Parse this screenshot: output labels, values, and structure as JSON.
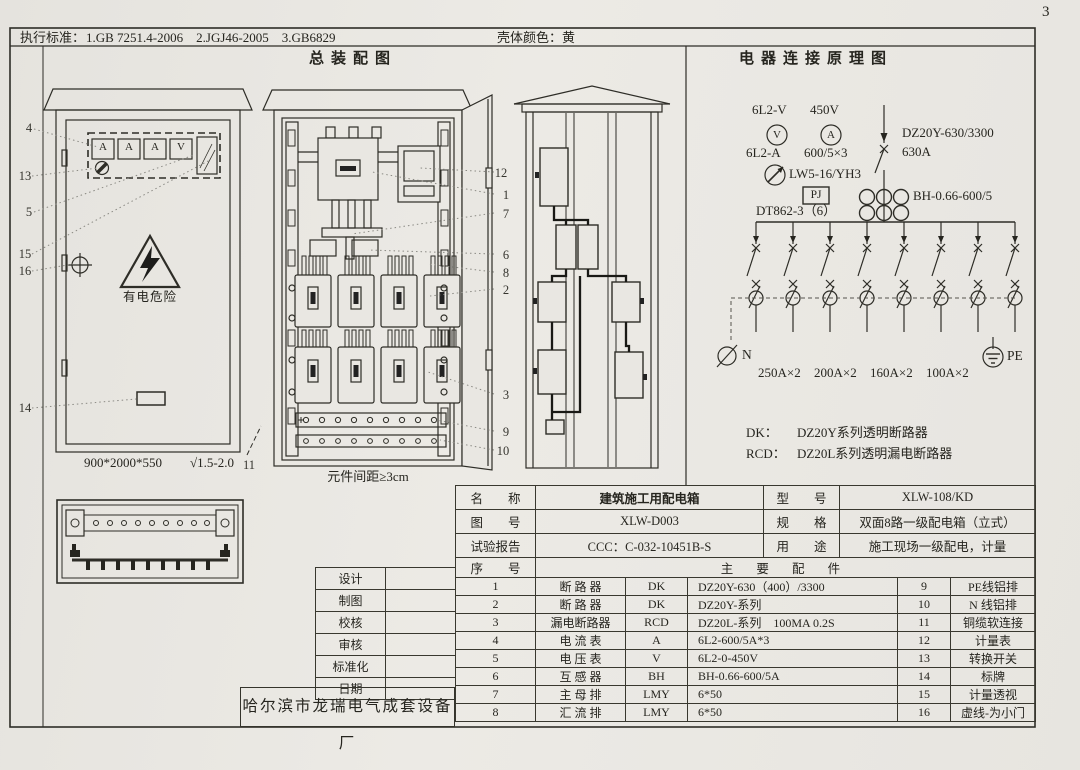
{
  "page_number": "3",
  "header": {
    "standards_label": "执行标准：",
    "standards": "1.GB 7251.4-2006    2.JGJ46-2005    3.GB6829",
    "shell_color_label": "壳体颜色：",
    "shell_color": "黄"
  },
  "assembly": {
    "title": "总装配图",
    "meter_labels": [
      "A",
      "A",
      "A",
      "V"
    ],
    "warning_text": "有电危险",
    "dimension": "900*2000*550",
    "finish": "√1.5-2.0",
    "callout_11": "11",
    "spacing_note": "元件间距≥3cm",
    "callouts_left": [
      "4",
      "13",
      "5",
      "15",
      "16",
      "14"
    ],
    "callouts_right": [
      "12",
      "1",
      "7",
      "6",
      "8",
      "2",
      "3",
      "9",
      "10"
    ]
  },
  "schematic": {
    "title": "电器连接原理图",
    "voltmeter_model": "6L2-V",
    "voltmeter_range": "450V",
    "voltmeter_letter": "V",
    "ammeter_letter": "A",
    "ammeter_model": "6L2-A",
    "ct_ratio": "600/5×3",
    "switch_model": "LW5-16/YH3",
    "pj_label": "PJ",
    "energy_meter": "DT862-3（6）",
    "main_breaker": "DZ20Y-630/3300",
    "main_rating": "630A",
    "ct_model": "BH-0.66-600/5",
    "neutral_label": "N",
    "pe_label": "PE",
    "branch_ratings": [
      "250A×2",
      "200A×2",
      "160A×2",
      "100A×2"
    ],
    "legend": [
      {
        "term": "DK：",
        "desc": "DZ20Y系列透明断路器"
      },
      {
        "term": "RCD：",
        "desc": "DZ20L系列透明漏电断路器"
      }
    ]
  },
  "title_block": {
    "rows": [
      {
        "label": "名　　称",
        "value": "建筑施工用配电箱",
        "label2": "型　　号",
        "value2": "XLW-108/KD"
      },
      {
        "label": "图　　号",
        "value": "XLW-D003",
        "label2": "规　　格",
        "value2": "双面8路一级配电箱（立式）"
      },
      {
        "label": "试验报告",
        "value": "CCC：C-032-10451B-S",
        "label2": "用　　途",
        "value2": "施工现场一级配电，计量"
      }
    ],
    "seq_header": "序　　号",
    "parts_header": "主  要  配  件",
    "parts": [
      {
        "no": "1",
        "name": "断 路 器",
        "code": "DK",
        "spec": "DZ20Y-630（400）/3300",
        "no2": "9",
        "name2": "PE线铝排"
      },
      {
        "no": "2",
        "name": "断 路 器",
        "code": "DK",
        "spec": "DZ20Y-系列",
        "no2": "10",
        "name2": "N 线铝排"
      },
      {
        "no": "3",
        "name": "漏电断路器",
        "code": "RCD",
        "spec": "DZ20L-系列　100MA 0.2S",
        "no2": "11",
        "name2": "铜缆软连接"
      },
      {
        "no": "4",
        "name": "电 流 表",
        "code": "A",
        "spec": "6L2-600/5A*3",
        "no2": "12",
        "name2": "计量表"
      },
      {
        "no": "5",
        "name": "电 压 表",
        "code": "V",
        "spec": "6L2-0-450V",
        "no2": "13",
        "name2": "转换开关"
      },
      {
        "no": "6",
        "name": "互 感 器",
        "code": "BH",
        "spec": "BH-0.66-600/5A",
        "no2": "14",
        "name2": "标牌"
      },
      {
        "no": "7",
        "name": "主 母 排",
        "code": "LMY",
        "spec": "6*50",
        "no2": "15",
        "name2": "计量透视"
      },
      {
        "no": "8",
        "name": "汇 流 排",
        "code": "LMY",
        "spec": "6*50",
        "no2": "16",
        "name2": "虚线-为小门"
      }
    ]
  },
  "sign_block": {
    "rows": [
      "设计",
      "制图",
      "校核",
      "审核",
      "标准化",
      "日期"
    ]
  },
  "manufacturer": "哈尔滨市龙瑞电气成套设备厂"
}
